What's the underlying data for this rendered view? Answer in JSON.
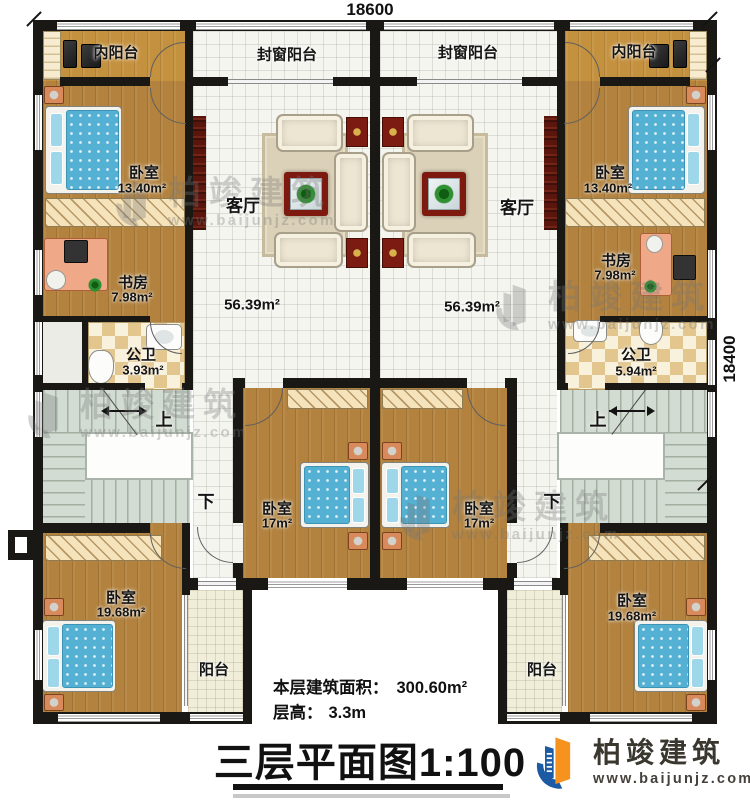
{
  "plan": {
    "dimensions": {
      "top": "18600",
      "right": "18400"
    },
    "units": [
      {
        "inner_balcony": "内阳台",
        "sealed_balcony": "封窗阳台",
        "bedroom_top": "卧室",
        "bedroom_top_area": "13.40m²",
        "living": "客厅",
        "living_area": "56.39m²",
        "study": "书房",
        "study_area": "7.98m²",
        "bath": "公卫",
        "bath_area": "3.93m²",
        "stairs_up": "上",
        "stairs_down": "下",
        "bedroom_mid": "卧室",
        "bedroom_mid_area": "17m²",
        "bedroom_bottom": "卧室",
        "bedroom_bottom_area": "19.68m²",
        "balcony": "阳台"
      },
      {
        "inner_balcony": "内阳台",
        "sealed_balcony": "封窗阳台",
        "bedroom_top": "卧室",
        "bedroom_top_area": "13.40m²",
        "living": "客厅",
        "living_area": "56.39m²",
        "study": "书房",
        "study_area": "7.98m²",
        "bath": "公卫",
        "bath_area": "5.94m²",
        "stairs_up": "上",
        "stairs_down": "下",
        "bedroom_mid": "卧室",
        "bedroom_mid_area": "17m²",
        "bedroom_bottom": "卧室",
        "bedroom_bottom_area": "19.68m²",
        "balcony": "阳台"
      }
    ],
    "footer": {
      "building_area_label": "本层建筑面积：",
      "building_area_value": "300.60m²",
      "floor_height_label": "层高：",
      "floor_height_value": "3.3m",
      "title": "三层平面图1:100"
    }
  },
  "brand": {
    "name": "柏竣建筑",
    "website": "www.baijunjz.com"
  },
  "watermark": {
    "name": "柏竣建筑",
    "website": "www.baijunjz.com"
  },
  "icons": {
    "brand_logo": "building-swoosh-logo"
  }
}
